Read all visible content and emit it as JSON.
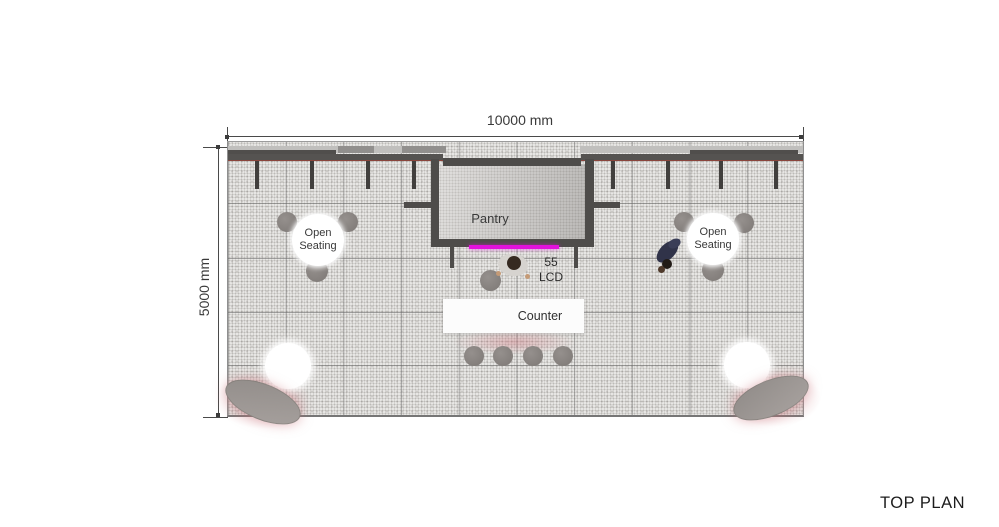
{
  "page": {
    "title": "TOP PLAN"
  },
  "dimensions": {
    "width_label": "10000 mm",
    "height_label": "5000 mm"
  },
  "plan": {
    "pantry_label": "Pantry",
    "lcd_label": "55\nLCD",
    "counter_label": "Counter",
    "open_seating_left_label": "Open\nSeating",
    "open_seating_right_label": "Open\nSeating"
  },
  "colors": {
    "lcd_accent": "#e212dc",
    "wall_dark": "#4e4c4a",
    "floor_base": "#edecea",
    "stool_gray": "#8c8784",
    "glow_pink": "#cd767e"
  }
}
